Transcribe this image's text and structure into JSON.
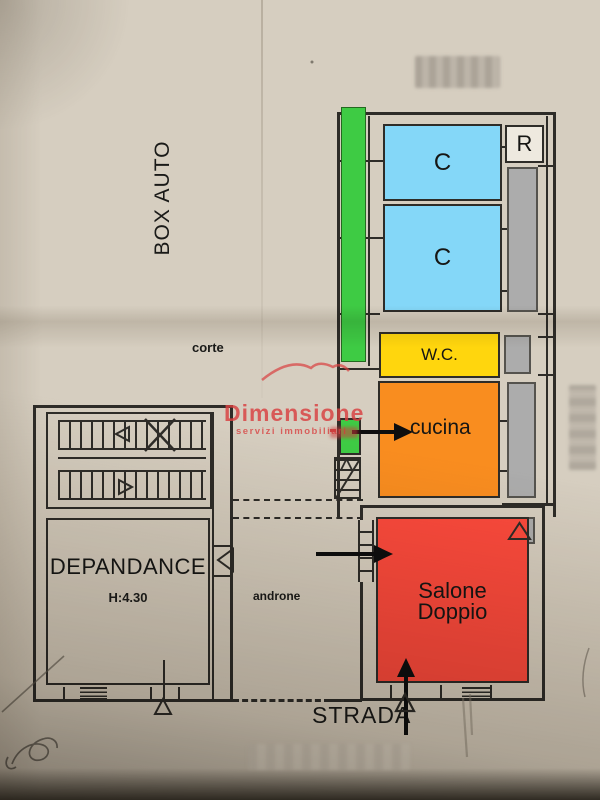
{
  "labels": {
    "box_auto": "BOX AUTO",
    "corte": "corte",
    "bedroom_1": "C",
    "bedroom_2": "C",
    "storage": "R",
    "wc": "W.C.",
    "kitchen": "cucina",
    "living_line1": "Salone",
    "living_line2": "Doppio",
    "depandance": "DEPANDANCE",
    "depandance_height": "H:4.30",
    "androne": "androne",
    "street": "STRADA"
  },
  "watermark": {
    "brand": "Dimensione",
    "subtitle": "servizi immobiliari"
  },
  "colors": {
    "paper": "#d6cec0",
    "green": "#3ecb44",
    "blue": "#84d7f8",
    "yellow": "#ffd60d",
    "orange": "#f98d1f",
    "red": "#fc4a3c",
    "gray": "#acacac",
    "wall": "#2e2c28",
    "watermark": "#d94040"
  },
  "symbols": {
    "entrance_arrow": "solid black arrow",
    "door_marker": "open triangle",
    "stair_cross": "X cross on stair flight"
  }
}
